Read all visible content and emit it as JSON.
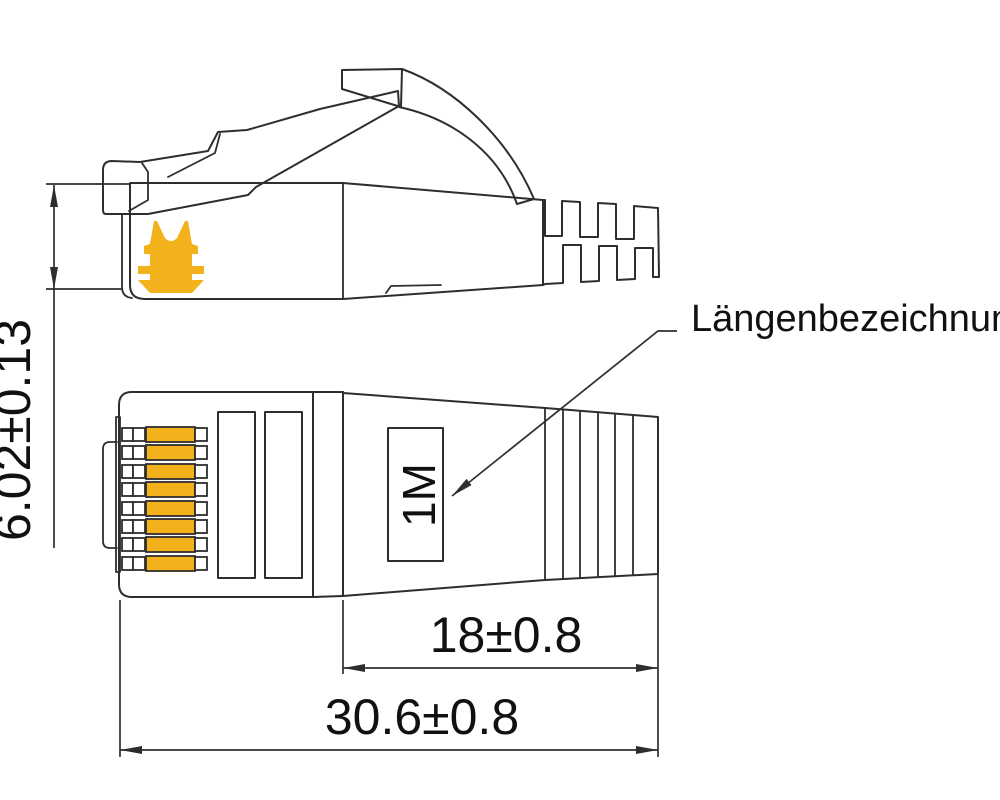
{
  "annotations": {
    "length_designation_label": "Längenbezeichnung",
    "length_marking": "1M"
  },
  "dimensions": {
    "plug_height": "6.02±0.13",
    "boot_length": "18±0.8",
    "overall_length": "30.6±0.8"
  },
  "pins": {
    "count": 8
  },
  "icons": {
    "clip_icon": "cable-clip-icon"
  },
  "colors": {
    "gold": "#F3B11C",
    "line": "#2e2e2e",
    "text": "#111111",
    "background": "#ffffff"
  }
}
